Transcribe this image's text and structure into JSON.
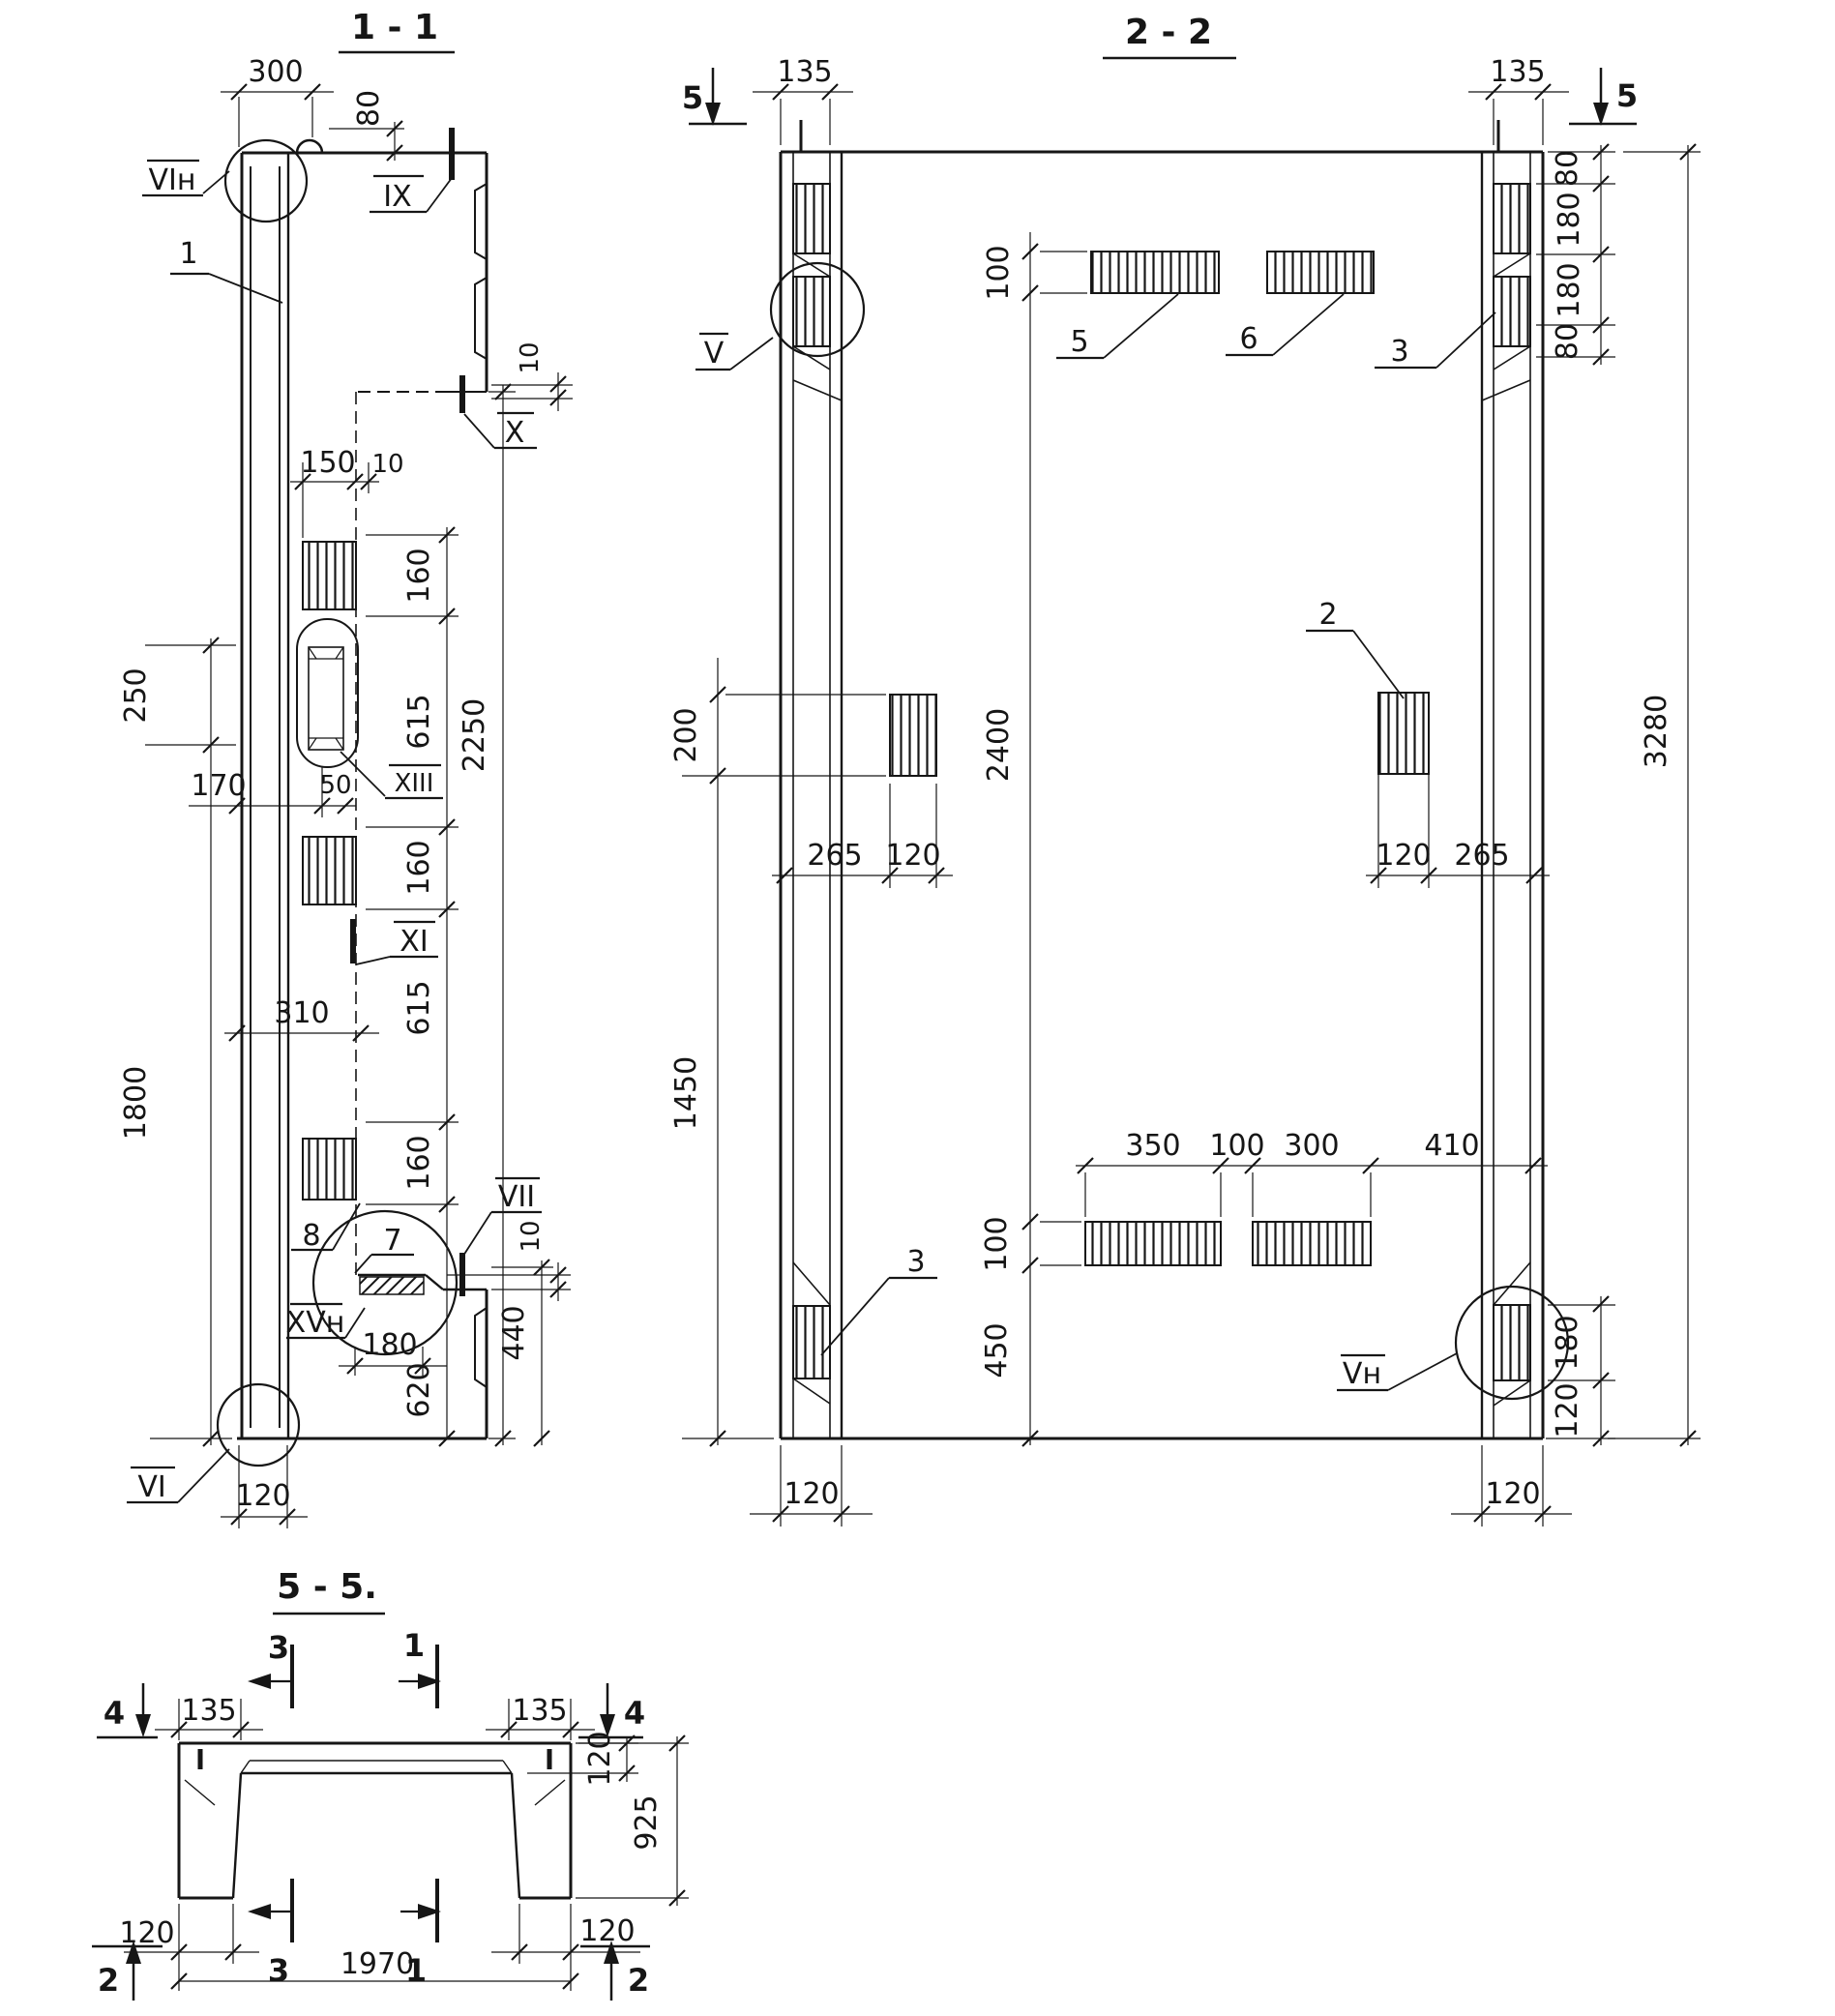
{
  "s11": {
    "title": "1 - 1",
    "d300": "300",
    "d80": "80",
    "d10a": "10",
    "d150": "150",
    "d10b": "10",
    "d160a": "160",
    "d615a": "615",
    "d160b": "160",
    "d615b": "615",
    "d160c": "160",
    "d620": "620",
    "d2250": "2250",
    "d250": "250",
    "d1800": "1800",
    "d170": "170",
    "d50": "50",
    "d310": "310",
    "d10c": "10",
    "d440": "440",
    "d180": "180",
    "d120": "120",
    "l_vin": "VIн",
    "l_1": "1",
    "l_ix": "IX",
    "l_x": "X",
    "l_xiii": "XIII",
    "l_xi": "XI",
    "l_vii": "VII",
    "l_xvn": "XVн",
    "l_vi": "VI",
    "l_7": "7",
    "l_8": "8"
  },
  "s22": {
    "title": "2 - 2",
    "m5l": "5",
    "m5r": "5",
    "d135l": "135",
    "d135r": "135",
    "d80a": "80",
    "d180a": "180",
    "d180b": "180",
    "d80b": "80",
    "d3280": "3280",
    "d100t": "100",
    "d2400": "2400",
    "d100b": "100",
    "d450": "450",
    "d200": "200",
    "d1450": "1450",
    "d265l": "265",
    "d120l": "120",
    "d120r": "120",
    "d265r": "265",
    "d350": "350",
    "d100m": "100",
    "d300": "300",
    "d410": "410",
    "d120bl": "120",
    "d120br": "120",
    "d180r": "180",
    "d120rs": "120",
    "l_v": "V",
    "l_vn": "Vн",
    "l_2": "2",
    "l_3t": "3",
    "l_3b": "3",
    "l_5": "5",
    "l_6": "6"
  },
  "s55": {
    "title": "5 - 5.",
    "m4l": "4",
    "m4r": "4",
    "m2l": "2",
    "m2r": "2",
    "m3t": "3",
    "m1t": "1",
    "m3b": "3",
    "m1b": "1",
    "d135l": "135",
    "d135r": "135",
    "d120t": "120",
    "d925": "925",
    "d120bl": "120",
    "d120br": "120",
    "d1970": "1970"
  }
}
